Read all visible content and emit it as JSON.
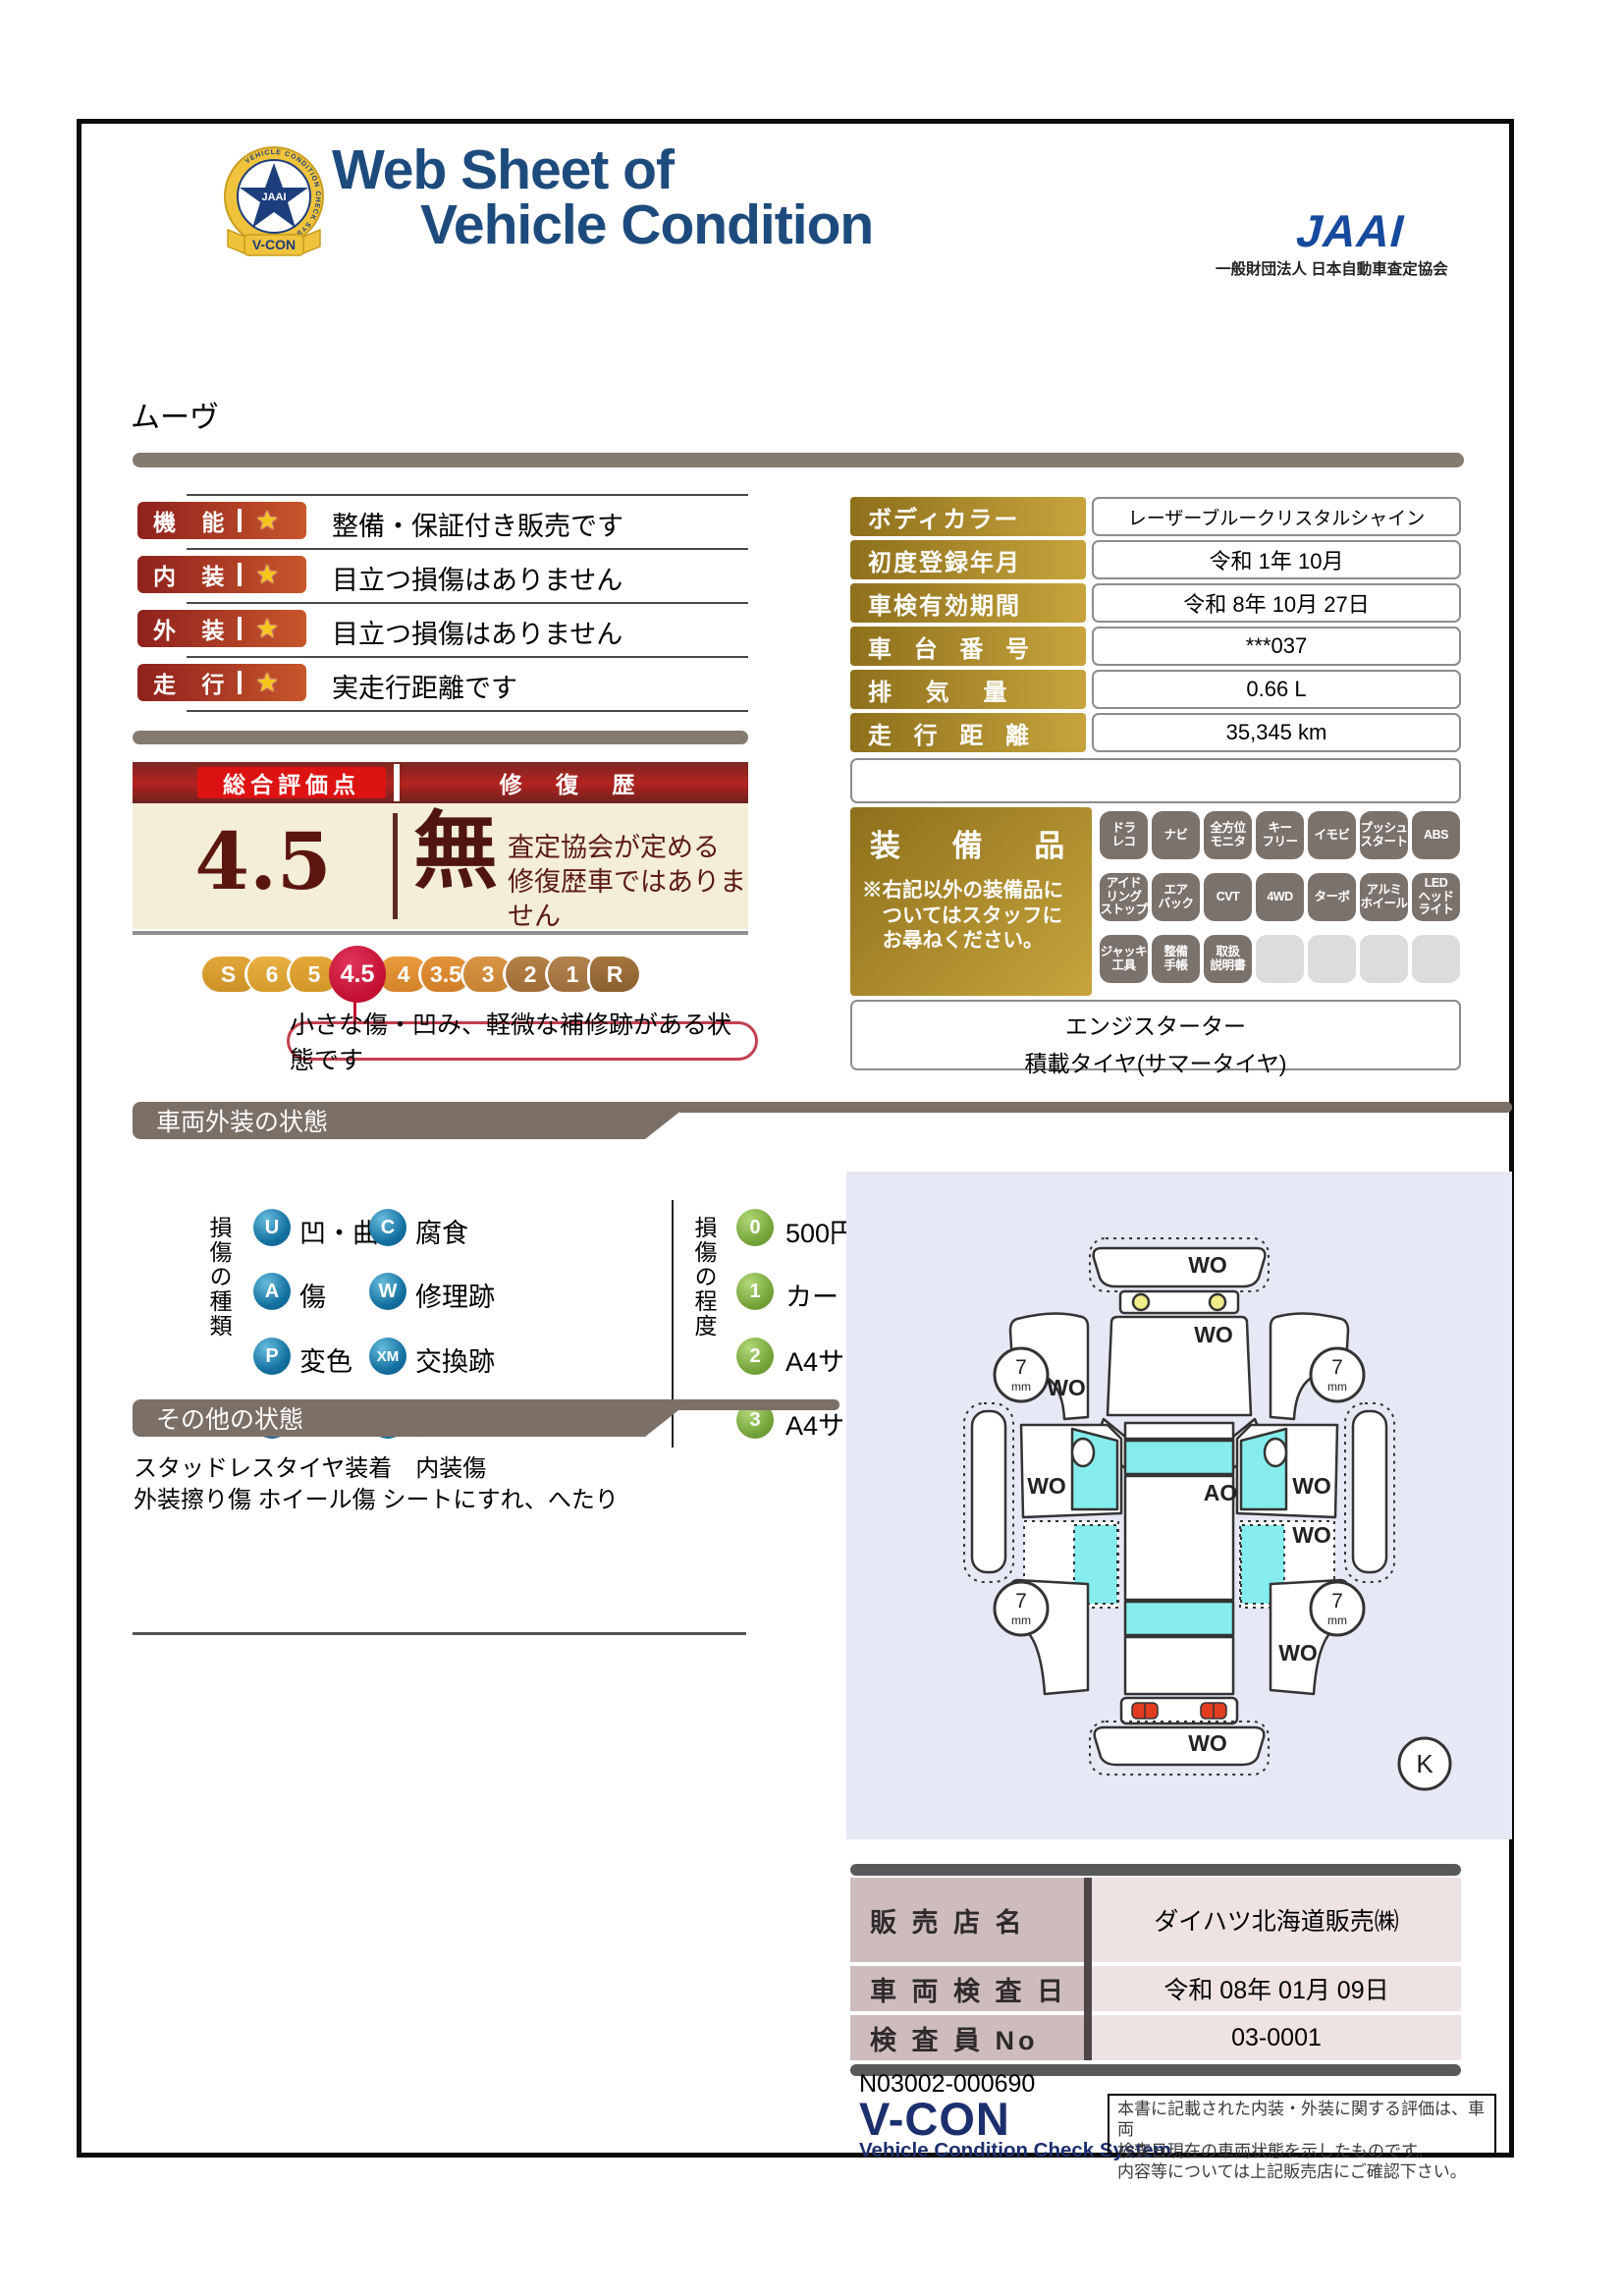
{
  "header": {
    "title_line1": "Web Sheet of",
    "title_line2": "Vehicle Condition",
    "jaai_logo": "JAAI",
    "jaai_org": "一般財団法人 日本自動車査定協会",
    "badge_ring": "VEHICLE CONDITION CHECK SYSTEM",
    "badge_center": "JAAI",
    "badge_vcon": "V-CON"
  },
  "vehicle_name": "ムーヴ",
  "ratings": [
    {
      "label": "機 能",
      "star": "★",
      "comment": "整備・保証付き販売です"
    },
    {
      "label": "内 装",
      "star": "★",
      "comment": "目立つ損傷はありません"
    },
    {
      "label": "外 装",
      "star": "★",
      "comment": "目立つ損傷はありません"
    },
    {
      "label": "走 行",
      "star": "★",
      "comment": "実走行距離です"
    }
  ],
  "overall": {
    "score_label": "総合評価点",
    "score": "4.5",
    "repair_label": "修 復 歴",
    "repair_value": "無",
    "repair_note": "査定協会が定める\n修復歴車ではありません",
    "scale": [
      "S",
      "6",
      "5",
      "4.5",
      "4",
      "3.5",
      "3",
      "2",
      "1",
      "R"
    ],
    "scale_comment": "小さな傷・凹み、軽微な補修跡がある状態です"
  },
  "info_table": {
    "rows": [
      {
        "label": "ボディカラー",
        "value": "レーザーブルークリスタルシャイン"
      },
      {
        "label": "初度登録年月",
        "value": "令和 1年 10月"
      },
      {
        "label": "車検有効期間",
        "value": "令和 8年 10月 27日"
      },
      {
        "label": "車 台 番 号",
        "value": "***037"
      },
      {
        "label": "排 気 量",
        "value": "0.66 L"
      },
      {
        "label": "走 行 距 離",
        "value": "35,345 km"
      }
    ]
  },
  "equipment": {
    "label": "装 備 品",
    "note": "※右記以外の装備品に\n　ついてはスタッフに\n　お尋ねください。",
    "badges": [
      "ドラ\nレコ",
      "ナビ",
      "全方位\nモニタ",
      "キー\nフリー",
      "イモビ",
      "プッシュ\nスタート",
      "ABS",
      "アイド\nリング\nストップ",
      "エア\nバック",
      "CVT",
      "4WD",
      "ターボ",
      "アルミ\nホイール",
      "LED\nヘッド\nライト",
      "ジャッキ\n工具",
      "整備\n手帳",
      "取扱\n説明書"
    ],
    "extra_line1": "エンジスターター",
    "extra_line2": "積載タイヤ(サマータイヤ)"
  },
  "exterior_section": {
    "title": "車両外装の状態",
    "kind_title": "損傷の種類",
    "kinds": [
      {
        "code": "U",
        "label": "凹・曲"
      },
      {
        "code": "C",
        "label": "腐食"
      },
      {
        "code": "A",
        "label": "傷"
      },
      {
        "code": "W",
        "label": "修理跡"
      },
      {
        "code": "P",
        "label": "変色"
      },
      {
        "code": "XM",
        "label": "交換跡"
      },
      {
        "code": "S",
        "label": "さび"
      },
      {
        "code": "T",
        "label": "割・穴"
      }
    ],
    "degree_title": "損傷の程度",
    "degrees": [
      {
        "code": "0",
        "label": "500円玉サイズ未満"
      },
      {
        "code": "1",
        "label": "カードサイズ未満"
      },
      {
        "code": "2",
        "label": "A4サイズ未満"
      },
      {
        "code": "3",
        "label": "A4サイズ以上"
      }
    ]
  },
  "other_section": {
    "title": "その他の状態",
    "text": "スタッドレスタイヤ装着　内装傷\n外装擦り傷 ホイール傷 シートにすれ、へたり"
  },
  "diagram": {
    "front_bumper": "WO",
    "hood": "WO",
    "left_fender": "WO",
    "left_front_door": "WO",
    "right_front_door": "WO",
    "right_rear_door": "WO",
    "right_rear_quarter": "WO",
    "rear_bumper": "WO",
    "roof_center": "AO",
    "tire_value": "7",
    "tire_unit": "mm",
    "key_mark": "K"
  },
  "dealer": {
    "rows": [
      {
        "label": "販 売 店 名",
        "value": "ダイハツ北海道販売㈱"
      },
      {
        "label": "車 両 検 査 日",
        "value": "令和 08年 01月 09日"
      },
      {
        "label": "検 査 員 No",
        "value": "03-0001"
      }
    ]
  },
  "footer": {
    "doc_number": "N03002-000690",
    "vcon": "V-CON",
    "vcon_sub": "Vehicle Condition Check System",
    "disclaimer": "本書に記載された内装・外装に関する評価は、車両\n検査日現在の車両状態を示したものです。\n内容等については上記販売店にご確認下さい。"
  },
  "colors": {
    "accent_red": "#c8562b",
    "gold": "#c7a43c",
    "navy": "#1d4b7d",
    "crimson": "#c30f31",
    "window_cyan": "#86ecec"
  }
}
